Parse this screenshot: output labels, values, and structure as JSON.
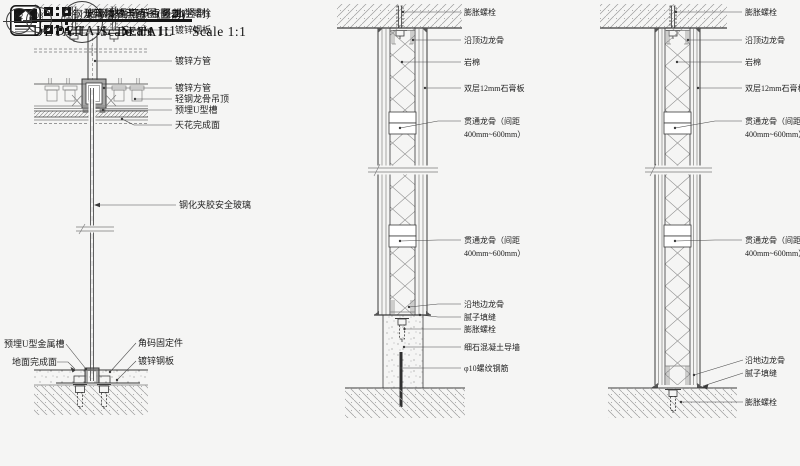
{
  "canvas": {
    "background": "#f5f5f4",
    "line_color": "#3a3a3a",
    "bar_color": "#141414"
  },
  "details": [
    {
      "title": "玻璃隔墙节点图(竖剖)",
      "detail_word": "DETAIL",
      "scale": "Scale 1:1",
      "logo_icon": "house-logo",
      "qr_icon": "qr-code",
      "labels": {
        "chemical_bolt": "化学螺栓",
        "galv_steel_plate": "镀锌钢板",
        "galv_square_tube_1": "镀锌方管",
        "galv_square_tube_2": "镀锌方管",
        "steel_keel_ceiling": "轻钢龙骨吊顶",
        "embedded_u_channel": "预埋U型槽",
        "ceiling_finish": "天花完成面",
        "laminated_glass": "钢化夹胶安全玻璃",
        "embedded_u_metal_channel": "预埋U型金属槽",
        "floor_finish": "地面完成面",
        "angle_fixing": "角码固定件",
        "galv_steel_plate_2": "镀锌钢板"
      }
    },
    {
      "number": "02",
      "title": "轻钢龙骨墙节点图一(竖剖)",
      "detail_word": "DETAIL",
      "scale": "Scale 1:1",
      "labels": {
        "expansion_bolt_top": "膨胀螺栓",
        "top_edge_keel": "沿顶边龙骨",
        "rock_wool": "岩棉",
        "gypsum_board": "双层12mm石膏板",
        "through_keel_1_line1": "贯通龙骨（间距",
        "through_keel_1_line2": "400mm~600mm）",
        "through_keel_2_line1": "贯通龙骨（间距",
        "through_keel_2_line2": "400mm~600mm）",
        "bottom_edge_keel": "沿地边龙骨",
        "putty_caulking": "腻子填缝",
        "expansion_bolt_bottom": "膨胀螺栓",
        "concrete_curb": "细石混凝土导墙",
        "rebar": "φ10螺纹钢筋"
      }
    },
    {
      "number": "03",
      "title": "轻钢龙骨墙节点图二(竖剖)",
      "detail_word": "DETAIL",
      "scale": "Scale 1:1",
      "labels": {
        "expansion_bolt_top": "膨胀螺栓",
        "top_edge_keel": "沿顶边龙骨",
        "rock_wool": "岩棉",
        "gypsum_board": "双层12mm石膏板",
        "through_keel_1_line1": "贯通龙骨（间距",
        "through_keel_1_line2": "400mm~600mm）",
        "through_keel_2_line1": "贯通龙骨（间距",
        "through_keel_2_line2": "400mm~600mm）",
        "bottom_edge_keel": "沿地边龙骨",
        "putty_caulking": "腻子填缝",
        "expansion_bolt_bottom": "膨胀螺栓"
      }
    }
  ]
}
